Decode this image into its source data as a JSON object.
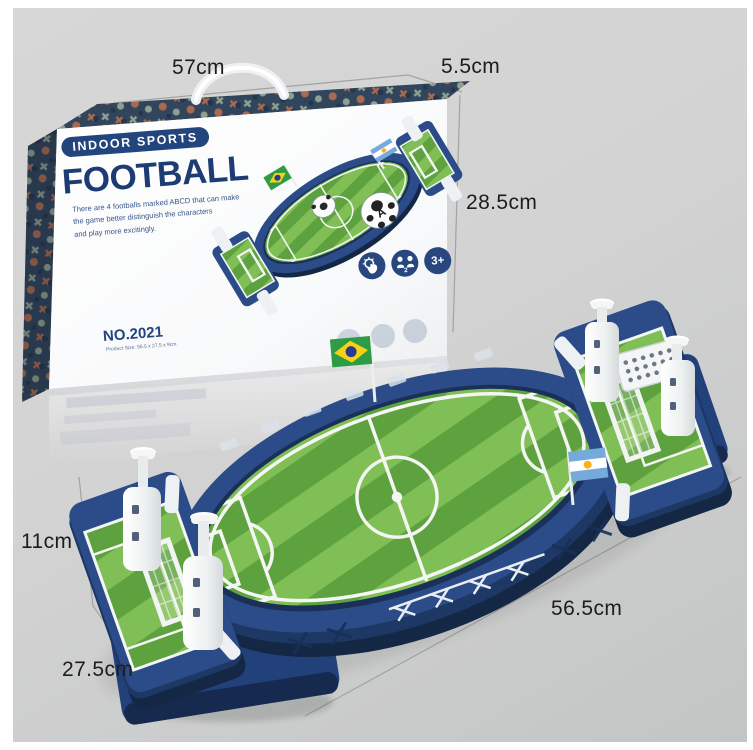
{
  "measurements": {
    "box_width": "57cm",
    "box_depth": "5.5cm",
    "box_height": "28.5cm",
    "toy_height": "11cm",
    "toy_depth": "27.5cm",
    "toy_length": "56.5cm"
  },
  "box": {
    "category_badge": "INDOOR SPORTS",
    "title": "FOOTBALL",
    "description_lines": [
      "There are 4 footballs marked ABCD that can make",
      "the game better distinguish the characters",
      "and play more excitingly."
    ],
    "model_number": "NO.2021",
    "size_note": "Product Size: 56.5 x 27.5 x 9cm",
    "age_badge": "3+",
    "players_count": "2",
    "ball_letter": "A",
    "icons": [
      "hand-play-icon",
      "two-players-icon",
      "age-3plus-badge"
    ]
  },
  "toy": {
    "flags": [
      "brazil-flag",
      "argentina-flag"
    ],
    "colors": {
      "frame_navy": "#2b4c88",
      "frame_navy_dark": "#1d3864",
      "frame_navy_deep": "#142845",
      "turf_light": "#80bf55",
      "turf_dark": "#5da23f",
      "plastic_white": "#f2f4f4",
      "marking_white": "#f4f6f4"
    }
  }
}
